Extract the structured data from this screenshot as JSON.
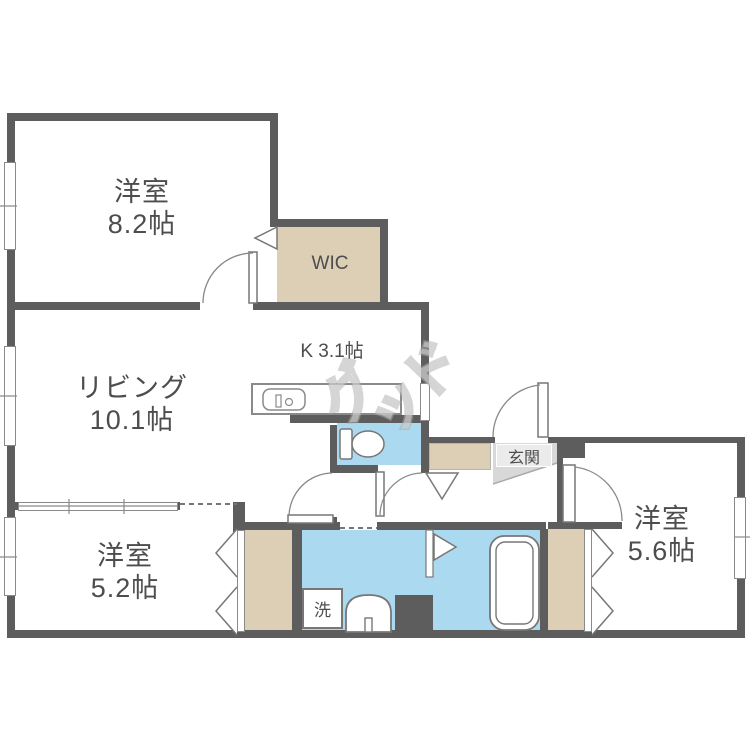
{
  "floorplan": {
    "rooms": {
      "bedroom1": {
        "name": "洋室",
        "size": "8.2帖"
      },
      "wic": {
        "label": "WIC"
      },
      "kitchen": {
        "label": "K 3.1帖"
      },
      "living": {
        "name": "リビング",
        "size": "10.1帖"
      },
      "bedroom2": {
        "name": "洋室",
        "size": "5.2帖"
      },
      "bedroom3": {
        "name": "洋室",
        "size": "5.6帖"
      },
      "entrance": {
        "label": "玄関"
      },
      "laundry": {
        "label": "洗"
      }
    },
    "watermark": {
      "ch0": "グ",
      "ch1": "ッ",
      "ch2": "ド"
    },
    "colors": {
      "wall": "#5d5d5d",
      "closet_beige": "#ddcfb5",
      "wet_area_blue": "#aad9f0",
      "entrance_gray": "#d8d8d8",
      "fixture_line": "#777777",
      "text": "#4d4d4d"
    }
  }
}
